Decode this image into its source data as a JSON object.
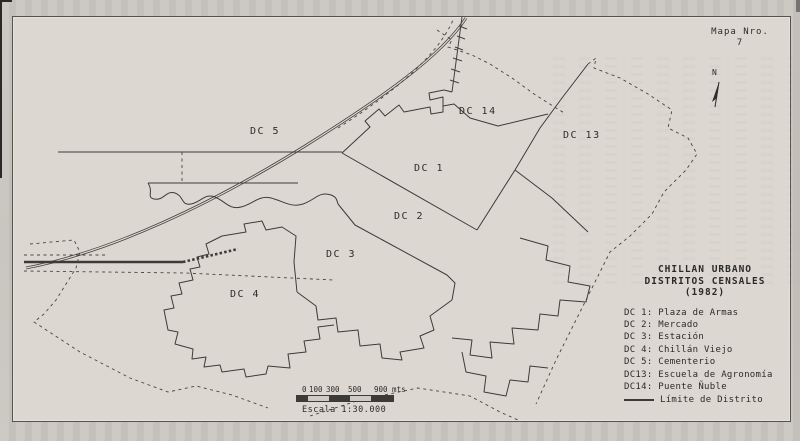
{
  "map": {
    "corner_label": {
      "line1": "Mapa Nro.",
      "line2": "7"
    },
    "north_label": "N",
    "district_labels": [
      {
        "text": "DC 5",
        "x": 250,
        "y": 126
      },
      {
        "text": "DC 14",
        "x": 459,
        "y": 106
      },
      {
        "text": "DC 1",
        "x": 414,
        "y": 163
      },
      {
        "text": "DC 13",
        "x": 563,
        "y": 130
      },
      {
        "text": "DC 2",
        "x": 394,
        "y": 211
      },
      {
        "text": "DC 3",
        "x": 326,
        "y": 249
      },
      {
        "text": "DC 4",
        "x": 230,
        "y": 289
      }
    ],
    "legend": {
      "title_lines": [
        "CHILLAN URBANO",
        "DISTRITOS CENSALES",
        "(1982)"
      ],
      "items": [
        "DC 1: Plaza de Armas",
        "DC 2: Mercado",
        "DC 3: Estación",
        "DC 4: Chillán Viejo",
        "DC 5: Cementerio",
        "DC13: Escuela de Agronomía",
        "DC14: Puente Ñuble"
      ],
      "limit_item": "Límite de Distrito"
    },
    "scale": {
      "tick_labels": [
        {
          "text": "0",
          "x": 6
        },
        {
          "text": "100",
          "x": 13
        },
        {
          "text": "300",
          "x": 30
        },
        {
          "text": "500",
          "x": 52
        },
        {
          "text": "900 mts",
          "x": 78
        }
      ],
      "bar_segments": [
        {
          "w": 11,
          "fill": "dark"
        },
        {
          "w": 21,
          "fill": "light"
        },
        {
          "w": 21,
          "fill": "dark"
        },
        {
          "w": 21,
          "fill": "light"
        },
        {
          "w": 22,
          "fill": "dark"
        }
      ],
      "caption": "Escala 1:30.000"
    },
    "colors": {
      "paper": "#dcd8d1",
      "outer_background": "#c7c3bd",
      "line": "#3d3b38"
    }
  }
}
